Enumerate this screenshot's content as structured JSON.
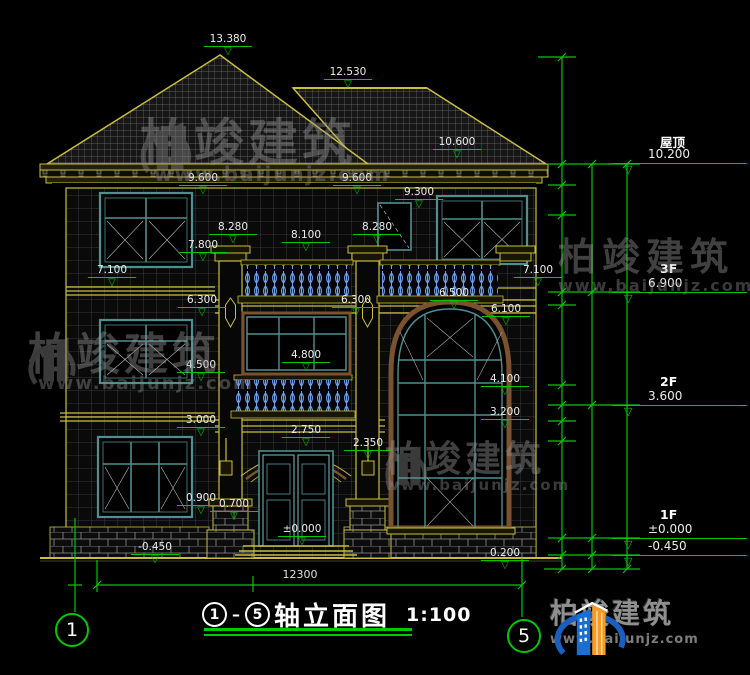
{
  "title_block": {
    "axis_start": "1",
    "separator": "–",
    "axis_end": "5",
    "name": "轴立面图",
    "scale": "1:100"
  },
  "watermark": {
    "brand": "柏竣建筑",
    "url": "www.baijunjz.com"
  },
  "logo": {
    "brand": "柏竣建筑",
    "url": "www.baijunjz.com"
  },
  "colors": {
    "dim_green": "#00c800",
    "outline_yellow": "#c9bf3b",
    "window_teal": "#4e8f8f",
    "baluster_blue": "#6d9fe8",
    "frame_brown": "#7a5230",
    "logo_blue": "#1a6fd4",
    "logo_orange": "#f59a23"
  },
  "drawing": {
    "axes": {
      "left": "1",
      "right": "5"
    },
    "bottom_dim": {
      "label": "12300",
      "x": 300,
      "y": 568
    },
    "annotations": [
      {
        "t": "13.380",
        "x": 228,
        "y": 33
      },
      {
        "t": "12.530",
        "x": 348,
        "y": 66
      },
      {
        "t": "10.600",
        "x": 457,
        "y": 136
      },
      {
        "t": "9.600",
        "x": 203,
        "y": 172
      },
      {
        "t": "9.600",
        "x": 357,
        "y": 172
      },
      {
        "t": "9.300",
        "x": 419,
        "y": 186
      },
      {
        "t": "8.280",
        "x": 233,
        "y": 221
      },
      {
        "t": "8.280",
        "x": 377,
        "y": 221
      },
      {
        "t": "8.100",
        "x": 306,
        "y": 229
      },
      {
        "t": "7.800",
        "x": 203,
        "y": 239
      },
      {
        "t": "7.100",
        "x": 112,
        "y": 264
      },
      {
        "t": "7.100",
        "x": 538,
        "y": 264
      },
      {
        "t": "6.500",
        "x": 454,
        "y": 287
      },
      {
        "t": "6.300",
        "x": 202,
        "y": 294
      },
      {
        "t": "6.300",
        "x": 356,
        "y": 294
      },
      {
        "t": "6.100",
        "x": 506,
        "y": 303
      },
      {
        "t": "4.800",
        "x": 306,
        "y": 349
      },
      {
        "t": "4.500",
        "x": 201,
        "y": 359
      },
      {
        "t": "4.100",
        "x": 505,
        "y": 373
      },
      {
        "t": "3.200",
        "x": 505,
        "y": 406
      },
      {
        "t": "3.000",
        "x": 201,
        "y": 414
      },
      {
        "t": "2.750",
        "x": 306,
        "y": 424
      },
      {
        "t": "2.350",
        "x": 368,
        "y": 437
      },
      {
        "t": "0.900",
        "x": 201,
        "y": 492
      },
      {
        "t": "0.700",
        "x": 234,
        "y": 498
      },
      {
        "t": "±0.000",
        "x": 302,
        "y": 523
      },
      {
        "t": "-0.450",
        "x": 155,
        "y": 541
      },
      {
        "t": "0.200",
        "x": 505,
        "y": 547
      }
    ],
    "dim_labels": [
      {
        "t": "2780",
        "x": 556,
        "y": 103
      },
      {
        "t": "400",
        "x": 556,
        "y": 171
      },
      {
        "t": "900",
        "x": 556,
        "y": 196
      },
      {
        "t": "2400",
        "x": 556,
        "y": 252
      },
      {
        "t": "400",
        "x": 556,
        "y": 301
      },
      {
        "t": "2400",
        "x": 556,
        "y": 351
      },
      {
        "t": "400",
        "x": 556,
        "y": 398
      },
      {
        "t": "500",
        "x": 556,
        "y": 413
      },
      {
        "t": "3000",
        "x": 556,
        "y": 482
      },
      {
        "t": "45000",
        "x": 552,
        "y": 548
      },
      {
        "t": "3300",
        "x": 586,
        "y": 230
      },
      {
        "t": "3300",
        "x": 586,
        "y": 351
      },
      {
        "t": "3600",
        "x": 586,
        "y": 482
      },
      {
        "t": "450",
        "x": 586,
        "y": 553
      },
      {
        "t": "10650",
        "x": 616,
        "y": 369
      }
    ],
    "floor_markers": [
      {
        "name": "屋顶",
        "elev": "10.200",
        "x": 612,
        "y": 163
      },
      {
        "name": "3F",
        "elev": "6.900",
        "x": 612,
        "y": 292
      },
      {
        "name": "2F",
        "elev": "3.600",
        "x": 612,
        "y": 405
      },
      {
        "name": "1F",
        "elev": "±0.000",
        "x": 612,
        "y": 538
      },
      {
        "name": "",
        "elev": "-0.450",
        "x": 612,
        "y": 555
      }
    ]
  }
}
